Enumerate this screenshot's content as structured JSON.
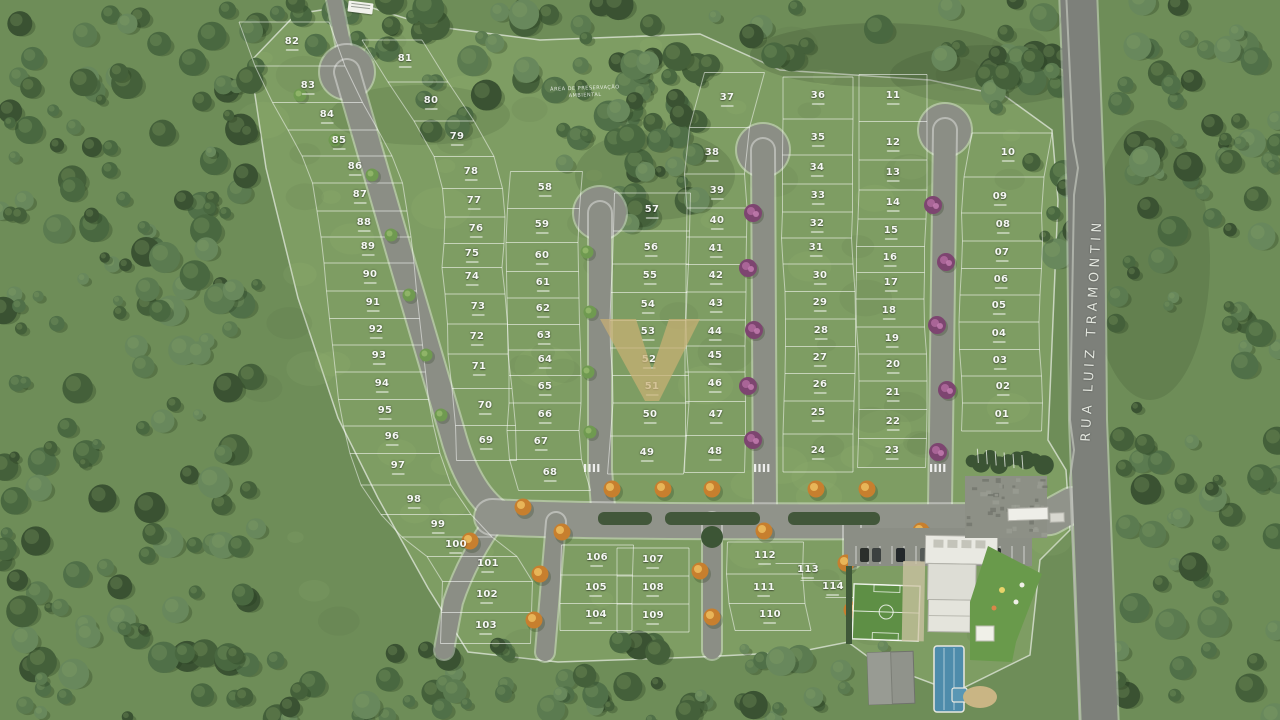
{
  "street": {
    "name": "RUA LUIZ TRAMONTIN"
  },
  "labels": {
    "preservation_line1": "ÁREA DE PRESERVAÇÃO",
    "preservation_line2": "AMBIENTAL"
  },
  "watermark": {
    "shape": "V-monogram",
    "color": "#c9b074"
  },
  "colors": {
    "site_grass": "#7e9d63",
    "outer_lawn": "#6e8d58",
    "forest": "#46603e",
    "road": "#8b8e85",
    "main_road": "#7d807a",
    "lot_line": "#ffffff",
    "pool": "#4e8cab",
    "soccer_field": "#5e8f45",
    "flowering_tree": "#9c5c8d",
    "autumn_tree": "#d29638",
    "watermark_gold": "#c9b074"
  },
  "lots": [
    {
      "n": "82",
      "x": 292,
      "y": 44,
      "c": "W"
    },
    {
      "n": "83",
      "x": 308,
      "y": 88,
      "c": "W"
    },
    {
      "n": "84",
      "x": 327,
      "y": 117,
      "c": "W"
    },
    {
      "n": "85",
      "x": 339,
      "y": 143,
      "c": "W"
    },
    {
      "n": "86",
      "x": 355,
      "y": 169,
      "c": "W"
    },
    {
      "n": "87",
      "x": 360,
      "y": 197,
      "c": "W"
    },
    {
      "n": "88",
      "x": 364,
      "y": 225,
      "c": "W"
    },
    {
      "n": "89",
      "x": 368,
      "y": 249,
      "c": "W"
    },
    {
      "n": "90",
      "x": 370,
      "y": 277,
      "c": "W"
    },
    {
      "n": "91",
      "x": 373,
      "y": 305,
      "c": "W"
    },
    {
      "n": "92",
      "x": 376,
      "y": 332,
      "c": "W"
    },
    {
      "n": "93",
      "x": 379,
      "y": 358,
      "c": "W"
    },
    {
      "n": "94",
      "x": 382,
      "y": 386,
      "c": "W"
    },
    {
      "n": "95",
      "x": 385,
      "y": 413,
      "c": "W"
    },
    {
      "n": "96",
      "x": 392,
      "y": 439,
      "c": "W"
    },
    {
      "n": "97",
      "x": 398,
      "y": 468,
      "c": "W"
    },
    {
      "n": "98",
      "x": 414,
      "y": 502,
      "c": "W"
    },
    {
      "n": "99",
      "x": 438,
      "y": 527,
      "c": "W"
    },
    {
      "n": "100",
      "x": 456,
      "y": 547,
      "c": "W"
    },
    {
      "n": "101",
      "x": 488,
      "y": 566,
      "c": "W"
    },
    {
      "n": "102",
      "x": 487,
      "y": 597,
      "c": "W"
    },
    {
      "n": "103",
      "x": 486,
      "y": 628,
      "c": "W"
    },
    {
      "n": "81",
      "x": 405,
      "y": 61,
      "c": "B"
    },
    {
      "n": "80",
      "x": 431,
      "y": 103,
      "c": "B"
    },
    {
      "n": "79",
      "x": 457,
      "y": 139,
      "c": "B"
    },
    {
      "n": "78",
      "x": 471,
      "y": 174,
      "c": "B"
    },
    {
      "n": "77",
      "x": 474,
      "y": 203,
      "c": "B"
    },
    {
      "n": "76",
      "x": 476,
      "y": 231,
      "c": "B"
    },
    {
      "n": "75",
      "x": 472,
      "y": 256,
      "c": "B"
    },
    {
      "n": "74",
      "x": 472,
      "y": 279,
      "c": "B"
    },
    {
      "n": "73",
      "x": 478,
      "y": 309,
      "c": "B"
    },
    {
      "n": "72",
      "x": 477,
      "y": 339,
      "c": "B"
    },
    {
      "n": "71",
      "x": 479,
      "y": 369,
      "c": "B"
    },
    {
      "n": "70",
      "x": 485,
      "y": 408,
      "c": "B"
    },
    {
      "n": "69",
      "x": 486,
      "y": 443,
      "c": "B"
    },
    {
      "n": "58",
      "x": 545,
      "y": 190,
      "c": "C"
    },
    {
      "n": "59",
      "x": 542,
      "y": 227,
      "c": "C"
    },
    {
      "n": "60",
      "x": 542,
      "y": 258,
      "c": "C"
    },
    {
      "n": "61",
      "x": 543,
      "y": 285,
      "c": "C"
    },
    {
      "n": "62",
      "x": 543,
      "y": 311,
      "c": "C"
    },
    {
      "n": "63",
      "x": 544,
      "y": 338,
      "c": "C"
    },
    {
      "n": "64",
      "x": 545,
      "y": 362,
      "c": "C"
    },
    {
      "n": "65",
      "x": 545,
      "y": 389,
      "c": "C"
    },
    {
      "n": "66",
      "x": 545,
      "y": 417,
      "c": "C"
    },
    {
      "n": "67",
      "x": 541,
      "y": 444,
      "c": "C"
    },
    {
      "n": "68",
      "x": 550,
      "y": 475,
      "c": "C"
    },
    {
      "n": "57",
      "x": 652,
      "y": 212,
      "c": "D"
    },
    {
      "n": "56",
      "x": 651,
      "y": 250,
      "c": "D"
    },
    {
      "n": "55",
      "x": 650,
      "y": 278,
      "c": "D"
    },
    {
      "n": "54",
      "x": 648,
      "y": 307,
      "c": "D"
    },
    {
      "n": "53",
      "x": 648,
      "y": 334,
      "c": "D"
    },
    {
      "n": "52",
      "x": 649,
      "y": 362,
      "c": "D"
    },
    {
      "n": "51",
      "x": 652,
      "y": 389,
      "c": "D"
    },
    {
      "n": "50",
      "x": 650,
      "y": 417,
      "c": "D"
    },
    {
      "n": "49",
      "x": 647,
      "y": 455,
      "c": "D"
    },
    {
      "n": "37",
      "x": 727,
      "y": 100,
      "c": "E"
    },
    {
      "n": "38",
      "x": 712,
      "y": 155,
      "c": "E"
    },
    {
      "n": "39",
      "x": 717,
      "y": 193,
      "c": "E"
    },
    {
      "n": "40",
      "x": 717,
      "y": 223,
      "c": "E"
    },
    {
      "n": "41",
      "x": 716,
      "y": 251,
      "c": "E"
    },
    {
      "n": "42",
      "x": 716,
      "y": 278,
      "c": "E"
    },
    {
      "n": "43",
      "x": 716,
      "y": 306,
      "c": "E"
    },
    {
      "n": "44",
      "x": 715,
      "y": 334,
      "c": "E"
    },
    {
      "n": "45",
      "x": 715,
      "y": 358,
      "c": "E"
    },
    {
      "n": "46",
      "x": 715,
      "y": 386,
      "c": "E"
    },
    {
      "n": "47",
      "x": 716,
      "y": 417,
      "c": "E"
    },
    {
      "n": "48",
      "x": 715,
      "y": 454,
      "c": "E"
    },
    {
      "n": "36",
      "x": 818,
      "y": 98,
      "c": "F"
    },
    {
      "n": "35",
      "x": 818,
      "y": 140,
      "c": "F"
    },
    {
      "n": "34",
      "x": 817,
      "y": 170,
      "c": "F"
    },
    {
      "n": "33",
      "x": 818,
      "y": 198,
      "c": "F"
    },
    {
      "n": "32",
      "x": 817,
      "y": 226,
      "c": "F"
    },
    {
      "n": "31",
      "x": 816,
      "y": 250,
      "c": "F"
    },
    {
      "n": "30",
      "x": 820,
      "y": 278,
      "c": "F"
    },
    {
      "n": "29",
      "x": 820,
      "y": 305,
      "c": "F"
    },
    {
      "n": "28",
      "x": 821,
      "y": 333,
      "c": "F"
    },
    {
      "n": "27",
      "x": 820,
      "y": 360,
      "c": "F"
    },
    {
      "n": "26",
      "x": 820,
      "y": 387,
      "c": "F"
    },
    {
      "n": "25",
      "x": 818,
      "y": 415,
      "c": "F"
    },
    {
      "n": "24",
      "x": 818,
      "y": 453,
      "c": "F"
    },
    {
      "n": "11",
      "x": 893,
      "y": 98,
      "c": "G"
    },
    {
      "n": "12",
      "x": 893,
      "y": 145,
      "c": "G"
    },
    {
      "n": "13",
      "x": 893,
      "y": 175,
      "c": "G"
    },
    {
      "n": "14",
      "x": 893,
      "y": 205,
      "c": "G"
    },
    {
      "n": "15",
      "x": 891,
      "y": 233,
      "c": "G"
    },
    {
      "n": "16",
      "x": 890,
      "y": 260,
      "c": "G"
    },
    {
      "n": "17",
      "x": 891,
      "y": 285,
      "c": "G"
    },
    {
      "n": "18",
      "x": 889,
      "y": 313,
      "c": "G"
    },
    {
      "n": "19",
      "x": 892,
      "y": 341,
      "c": "G"
    },
    {
      "n": "20",
      "x": 893,
      "y": 367,
      "c": "G"
    },
    {
      "n": "21",
      "x": 893,
      "y": 395,
      "c": "G"
    },
    {
      "n": "22",
      "x": 893,
      "y": 424,
      "c": "G"
    },
    {
      "n": "23",
      "x": 892,
      "y": 453,
      "c": "G"
    },
    {
      "n": "10",
      "x": 1008,
      "y": 155,
      "c": "H"
    },
    {
      "n": "09",
      "x": 1000,
      "y": 199,
      "c": "H"
    },
    {
      "n": "08",
      "x": 1003,
      "y": 227,
      "c": "H"
    },
    {
      "n": "07",
      "x": 1002,
      "y": 255,
      "c": "H"
    },
    {
      "n": "06",
      "x": 1001,
      "y": 282,
      "c": "H"
    },
    {
      "n": "05",
      "x": 999,
      "y": 308,
      "c": "H"
    },
    {
      "n": "04",
      "x": 999,
      "y": 336,
      "c": "H"
    },
    {
      "n": "03",
      "x": 1000,
      "y": 363,
      "c": "H"
    },
    {
      "n": "02",
      "x": 1003,
      "y": 389,
      "c": "H"
    },
    {
      "n": "01",
      "x": 1002,
      "y": 417,
      "c": "H"
    },
    {
      "n": "106",
      "x": 597,
      "y": 560,
      "c": "S1"
    },
    {
      "n": "105",
      "x": 596,
      "y": 590,
      "c": "S1"
    },
    {
      "n": "104",
      "x": 596,
      "y": 617,
      "c": "S1"
    },
    {
      "n": "107",
      "x": 653,
      "y": 562,
      "c": "S2"
    },
    {
      "n": "108",
      "x": 653,
      "y": 590,
      "c": "S2"
    },
    {
      "n": "109",
      "x": 653,
      "y": 618,
      "c": "S2"
    },
    {
      "n": "112",
      "x": 765,
      "y": 558,
      "c": "S3"
    },
    {
      "n": "111",
      "x": 764,
      "y": 590,
      "c": "S3"
    },
    {
      "n": "110",
      "x": 770,
      "y": 617,
      "c": "S3"
    },
    {
      "n": "113",
      "x": 808,
      "y": 572,
      "c": "S4"
    },
    {
      "n": "114",
      "x": 833,
      "y": 589,
      "c": "S4"
    }
  ]
}
